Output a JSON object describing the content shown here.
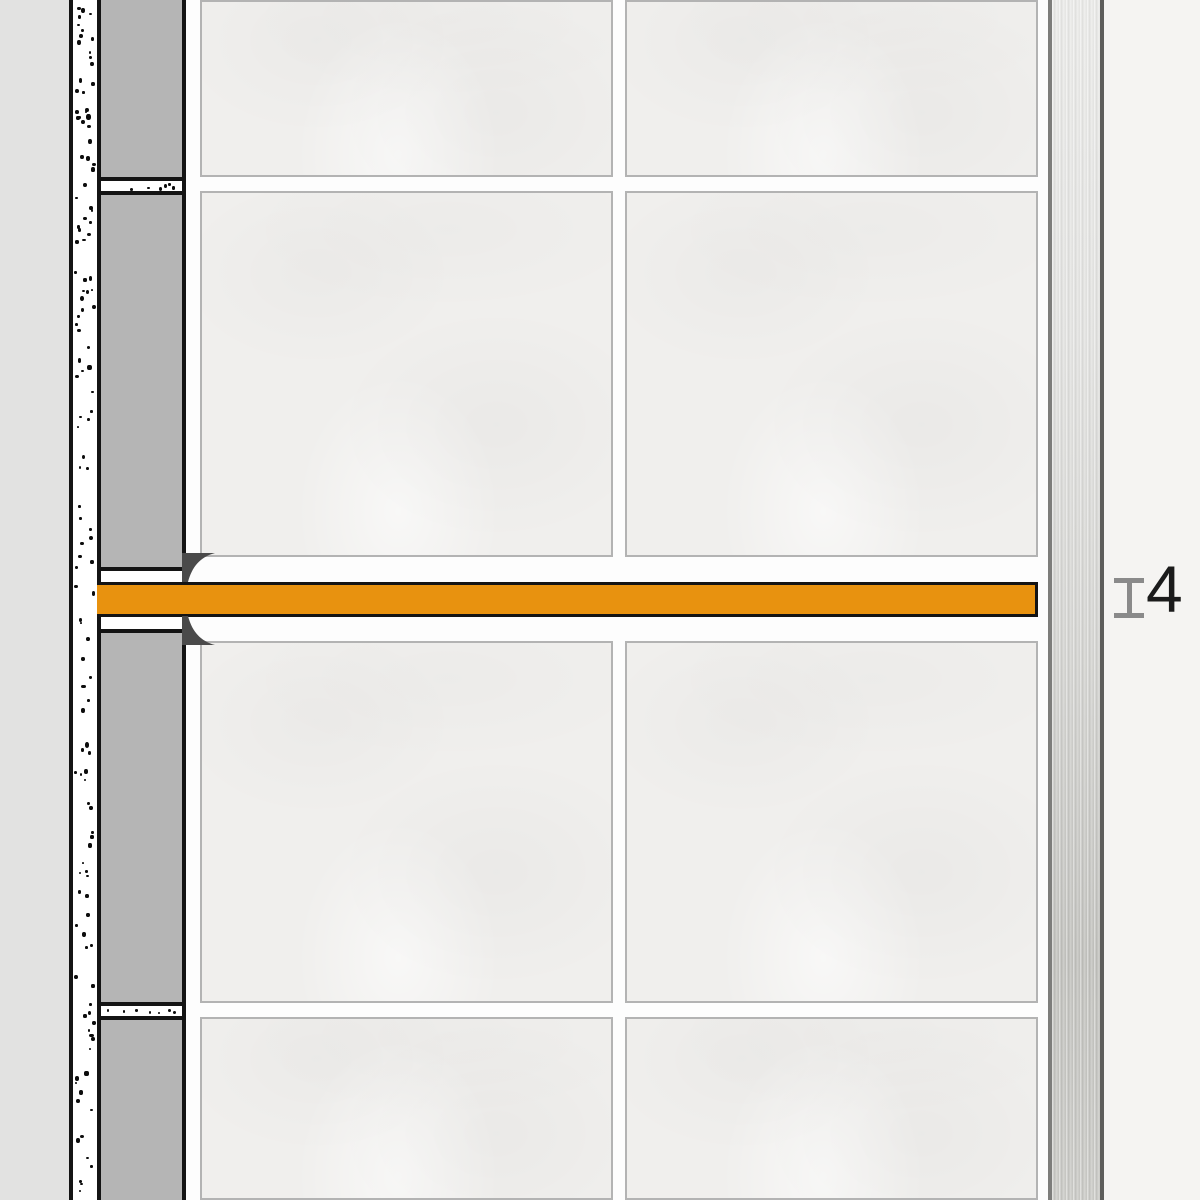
{
  "diagram": {
    "type": "installation-cross-section",
    "description": "Wall cross-section: substrate with mortar bed, gray adhesive layer, large-format tiles with grout joints, an orange shelf profile inserted in a horizontal tile joint, and a brushed stainless-steel edge profile on the right",
    "dimension": {
      "label": "4",
      "meaning": "profile joint thickness"
    },
    "colors": {
      "wall_background": "#E2E2E1",
      "outline": "#141414",
      "mortar_white": "#FFFFFF",
      "adhesive_gray": "#B5B5B5",
      "tile_fill": "#F0EFED",
      "tile_border": "#B3B3B3",
      "grout": "#FDFDFD",
      "profile_orange": "#E8920F",
      "anchor_wedge": "#4A4A4A",
      "metal_light": "#EBEBE9",
      "metal_dark": "#C2C2BE",
      "right_background": "#F5F4F2",
      "dimension_marker": "#8A8A8A",
      "dimension_text": "#1B1B1B"
    }
  }
}
